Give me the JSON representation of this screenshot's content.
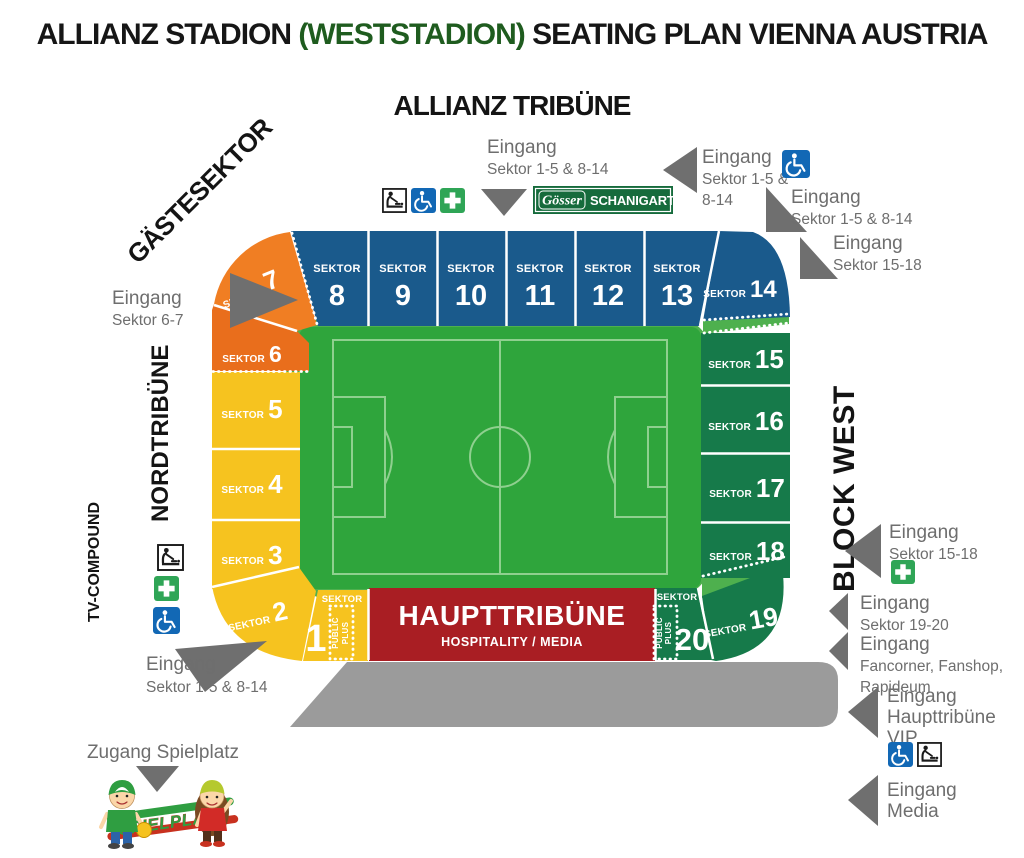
{
  "title": {
    "part1": "ALLIANZ STADION ",
    "highlight": "(WESTSTADION)",
    "part2": " SEATING PLAN VIENNA AUSTRIA"
  },
  "stands": {
    "top": "ALLIANZ TRIBÜNE",
    "guest": "GÄSTESEKTOR",
    "north": "NORDTRIBÜNE",
    "tv": "TV-COMPOUND",
    "west": "BLOCK WEST",
    "main": {
      "title": "HAUPTTRIBÜNE",
      "subtitle": "HOSPITALITY / MEDIA"
    }
  },
  "banner": {
    "brand": "Gösser",
    "label": "SCHANIGARTEN"
  },
  "sector_word": "SEKTOR",
  "public_plus": {
    "line1": "PUBLIC",
    "line2": "PLUS"
  },
  "sectors": {
    "top": [
      "8",
      "9",
      "10",
      "11",
      "12",
      "13"
    ],
    "corner_ne": "14",
    "west": [
      "15",
      "16",
      "17",
      "18"
    ],
    "corner_se": "19",
    "south_right": "20",
    "corner_nw": "7",
    "north_upper": "6",
    "north": [
      "5",
      "4",
      "3"
    ],
    "corner_sw": "2",
    "south_left": "1"
  },
  "entrances": {
    "top_center": {
      "l1": "Eingang",
      "l2": "Sektor 1-5 & 8-14"
    },
    "top_right_a": {
      "l1": "Eingang",
      "l2": "Sektor 1-5 &",
      "l3": "8-14"
    },
    "top_right_b": {
      "l1": "Eingang",
      "l2": "Sektor 1-5 & 8-14"
    },
    "top_right_c": {
      "l1": "Eingang",
      "l2": "Sektor 15-18"
    },
    "west_gate": {
      "l1": "Eingang",
      "l2": "Sektor 6-7"
    },
    "southwest": {
      "l1": "Eingang",
      "l2": "Sektor 1-5 & 8-14"
    },
    "east_mid": {
      "l1": "Eingang",
      "l2": "Sektor 15-18"
    },
    "east_19_20": {
      "l1": "Eingang",
      "l2": "Sektor 19-20"
    },
    "east_fan": {
      "l1": "Eingang",
      "l2": "Fancorner, Fanshop,",
      "l3": "Rapideum"
    },
    "east_vip": {
      "l1": "Eingang",
      "l2": "Haupttribüne",
      "l3": "VIP"
    },
    "east_media": {
      "l1": "Eingang",
      "l2": "Media"
    }
  },
  "playground": {
    "label": "Zugang Spielplatz",
    "badge": "SPIELPLATZ"
  },
  "icons": [
    "baby-changing",
    "wheelchair",
    "first-aid"
  ],
  "colors": {
    "blue": "#1A5A8C",
    "orange": "#F07E23",
    "orange_deep": "#E96E1C",
    "yellow": "#F6C31F",
    "green_dark": "#167A4A",
    "red": "#A91E23",
    "pitch": "#2FA53C",
    "apron": "#4EB04E",
    "pitch_lines": "#8FD08F",
    "gray_band": "#9B9B9B",
    "arrow_gray": "#6F6F6F",
    "entrance_text": "#6E6E6E",
    "banner_green": "#166B3C",
    "wheelchair_blue": "#1268B5",
    "firstaid_green": "#2FA556",
    "title_green": "#1F5C1F"
  }
}
